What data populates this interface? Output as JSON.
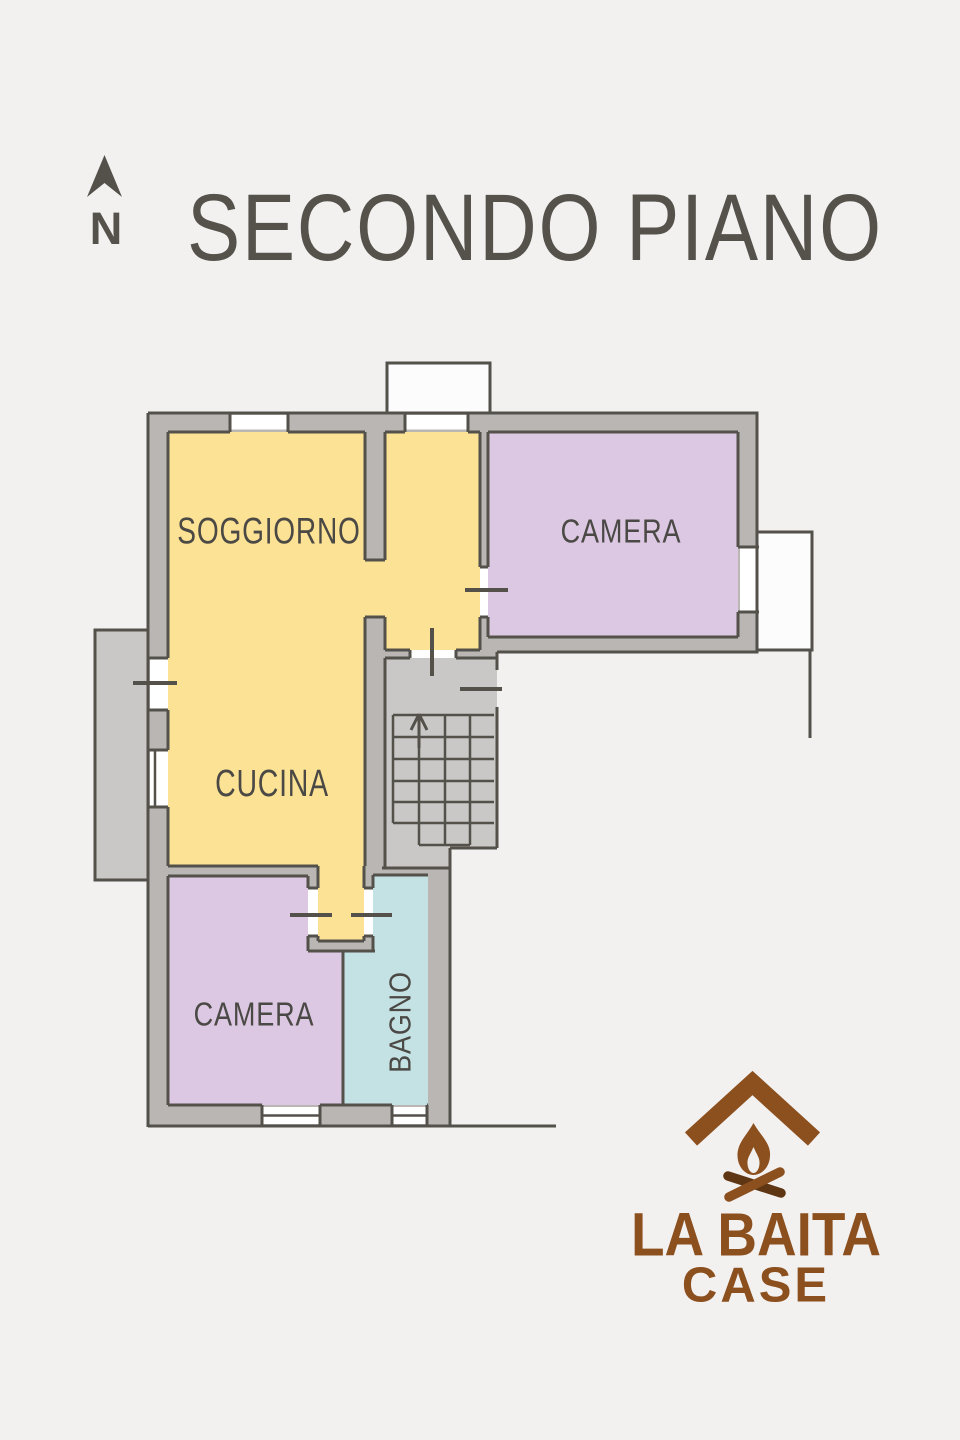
{
  "title": "SECONDO PIANO",
  "compass": {
    "letter": "N"
  },
  "rooms": [
    {
      "id": "soggiorno",
      "label": "SOGGIORNO"
    },
    {
      "id": "camera-nord",
      "label": "CAMERA"
    },
    {
      "id": "cucina",
      "label": "CUCINA"
    },
    {
      "id": "camera-sud",
      "label": "CAMERA"
    },
    {
      "id": "bagno",
      "label": "BAGNO"
    }
  ],
  "stairs": {
    "has_up_arrow": true
  },
  "logo": {
    "line1": "LA BAITA",
    "line2": "CASE"
  },
  "colors": {
    "background": "#f2f1f0",
    "wall_fill": "#b9b6b4",
    "wall_line": "#54514b",
    "room_living": "#fce294",
    "room_bedroom": "#dcc8e2",
    "room_bath": "#c4e1e3",
    "common_area": "#cac8c6",
    "window_white": "#ffffff",
    "label_text": "#4b4945",
    "title_text": "#55514b",
    "logo_brown": "#8c4f1e",
    "logo_brown_dark": "#5f3614"
  }
}
